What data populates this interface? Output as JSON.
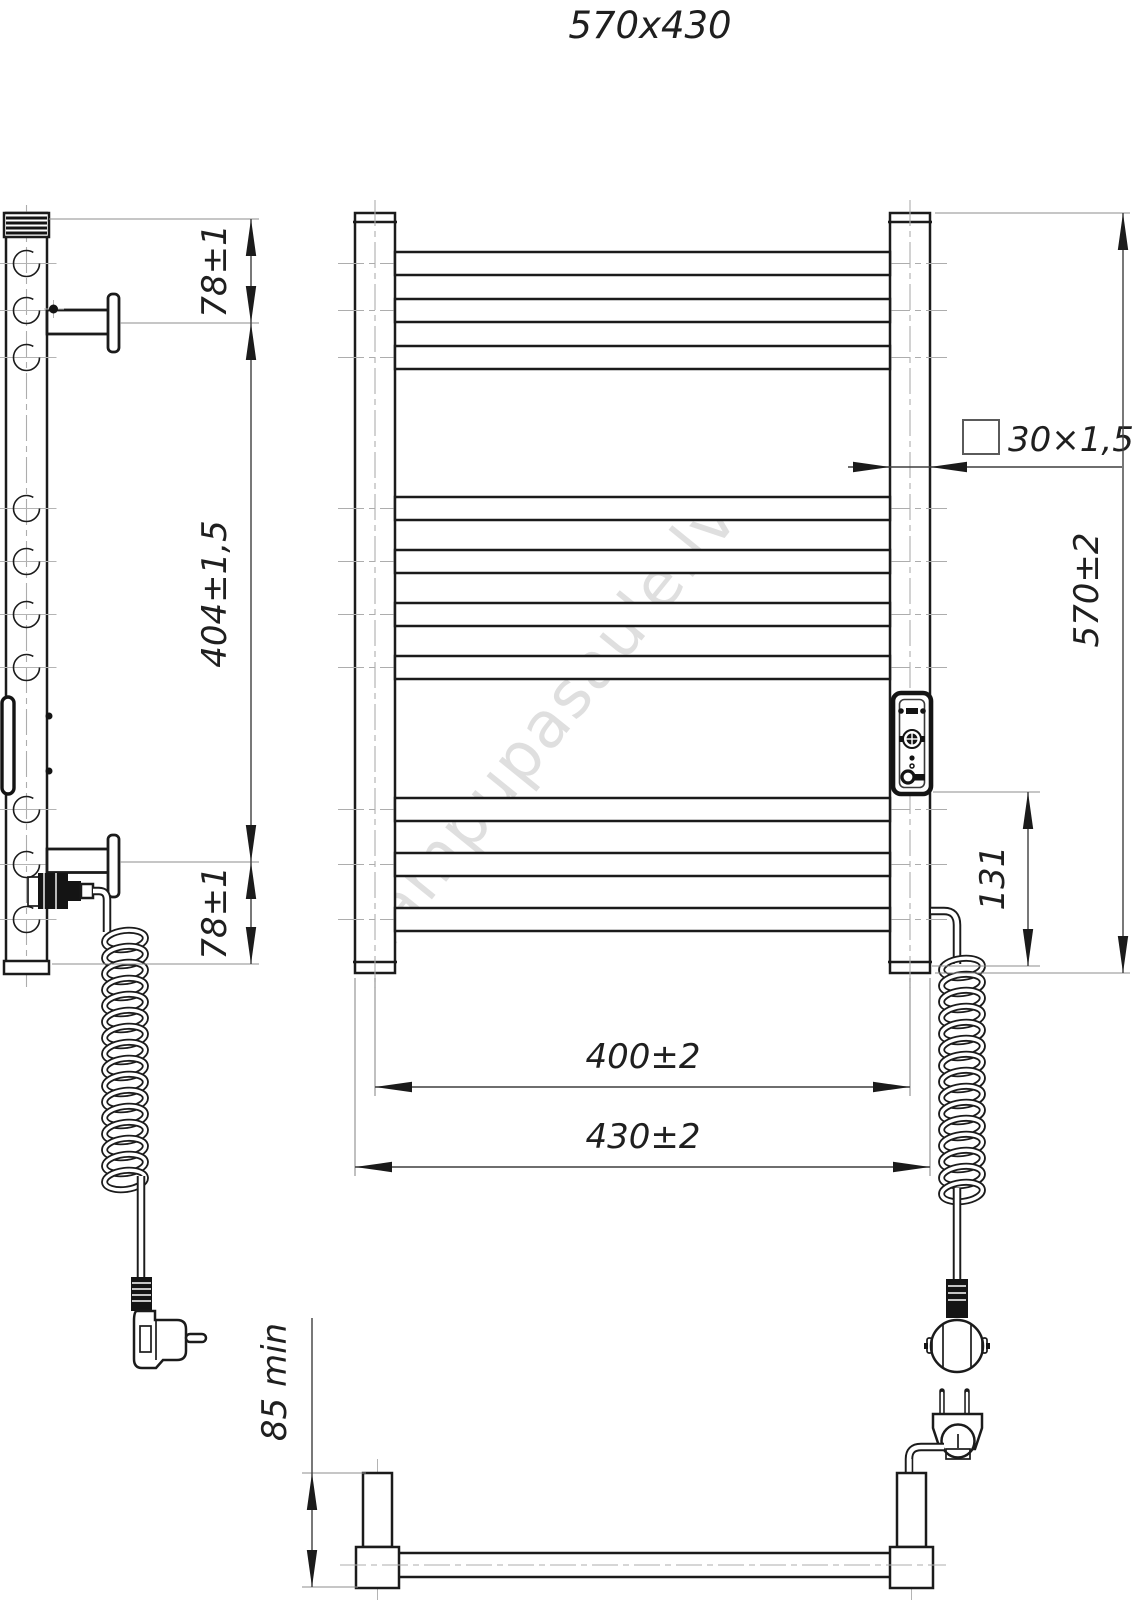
{
  "title": "570x430",
  "watermark": "lampupasaule.lv",
  "dims": {
    "side_top": "78±1",
    "side_span": "404±1,5",
    "side_bottom": "78±1",
    "tube_profile": "30×1,5",
    "height": "570±2",
    "controller_offset": "131",
    "inner_width": "400±2",
    "outer_width": "430±2",
    "wall_clearance": "85 min"
  }
}
